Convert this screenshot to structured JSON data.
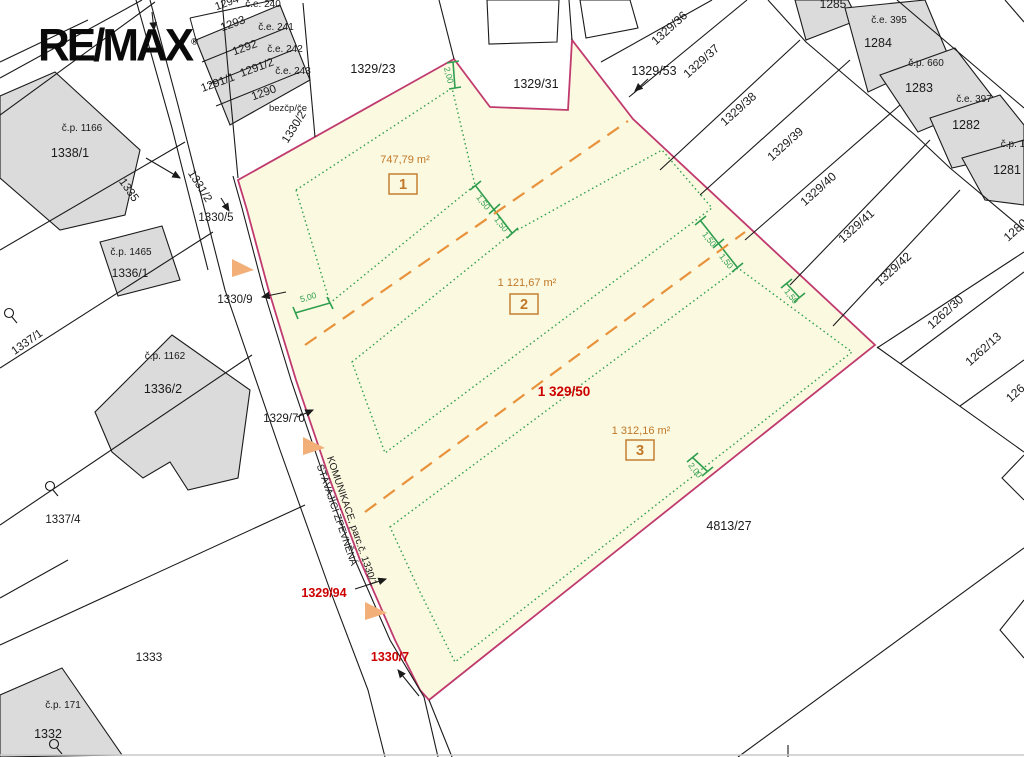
{
  "logo": {
    "text": "RE/MAX",
    "registered": "®"
  },
  "colors": {
    "black": "#1a1a1a",
    "red": "#cc0000",
    "orange": "#c07828",
    "orange_dash": "#e8923c",
    "green": "#2f9e4e",
    "magenta": "#c03a6f",
    "parcel_fill": "#fbf9e0",
    "building_fill": "#dbdbdb",
    "triangle": "#f2b078"
  },
  "parcels": [
    {
      "no": "1",
      "area": "747,79 m²",
      "box_x": 403,
      "box_y": 184,
      "ax": 405,
      "ay": 163
    },
    {
      "no": "2",
      "area": "1 121,67 m²",
      "box_x": 524,
      "box_y": 304,
      "ax": 527,
      "ay": 286
    },
    {
      "no": "3",
      "area": "1 312,16 m²",
      "box_x": 640,
      "box_y": 450,
      "ax": 641,
      "ay": 434
    }
  ],
  "labels": [
    {
      "t": "1294",
      "x": 228,
      "y": 6,
      "r": -20,
      "s": 11,
      "c": "k"
    },
    {
      "t": "č.e. 240",
      "x": 263,
      "y": 7,
      "r": 0,
      "s": 10,
      "c": "k"
    },
    {
      "t": "1293",
      "x": 234,
      "y": 27,
      "r": -20,
      "s": 11.5,
      "c": "k"
    },
    {
      "t": "č.e. 241",
      "x": 276,
      "y": 30,
      "r": 0,
      "s": 10,
      "c": "k"
    },
    {
      "t": "1292",
      "x": 246,
      "y": 51,
      "r": -20,
      "s": 11.5,
      "c": "k"
    },
    {
      "t": "č.e. 242",
      "x": 285,
      "y": 52,
      "r": 0,
      "s": 10,
      "c": "k"
    },
    {
      "t": "1291/2",
      "x": 258,
      "y": 71,
      "r": -20,
      "s": 11.5,
      "c": "k"
    },
    {
      "t": "č.e. 243",
      "x": 293,
      "y": 74,
      "r": 0,
      "s": 10,
      "c": "k"
    },
    {
      "t": "1291/1",
      "x": 219,
      "y": 86,
      "r": -20,
      "s": 11.5,
      "c": "k"
    },
    {
      "t": "1290",
      "x": 265,
      "y": 96,
      "r": -20,
      "s": 11.5,
      "c": "k"
    },
    {
      "t": "bezčp/če",
      "x": 288,
      "y": 111,
      "r": 0,
      "s": 9.5,
      "c": "k"
    },
    {
      "t": "1330/2",
      "x": 297,
      "y": 129,
      "r": -58,
      "s": 11.5,
      "c": "k"
    },
    {
      "t": "č.p. 1166",
      "x": 82,
      "y": 131,
      "r": 0,
      "s": 10,
      "c": "k"
    },
    {
      "t": "1338/1",
      "x": 70,
      "y": 157,
      "r": 0,
      "s": 12.5,
      "c": "k"
    },
    {
      "t": "1335",
      "x": 126,
      "y": 192,
      "r": 55,
      "s": 11.5,
      "c": "k"
    },
    {
      "t": "1331/2",
      "x": 197,
      "y": 188,
      "r": 58,
      "s": 11.5,
      "c": "k"
    },
    {
      "t": "1330/5",
      "x": 216,
      "y": 221,
      "r": 0,
      "s": 11.5,
      "c": "k"
    },
    {
      "t": "1330/9",
      "x": 235,
      "y": 303,
      "r": 0,
      "s": 11.5,
      "c": "k"
    },
    {
      "t": "1337/1",
      "x": 29,
      "y": 345,
      "r": -35,
      "s": 11.5,
      "c": "k"
    },
    {
      "t": "č.p. 1465",
      "x": 131,
      "y": 255,
      "r": 0,
      "s": 10,
      "c": "k"
    },
    {
      "t": "1336/1",
      "x": 130,
      "y": 277,
      "r": 0,
      "s": 12,
      "c": "k"
    },
    {
      "t": "č.p. 1162",
      "x": 165,
      "y": 359,
      "r": 0,
      "s": 10,
      "c": "k"
    },
    {
      "t": "1336/2",
      "x": 163,
      "y": 393,
      "r": 0,
      "s": 12.5,
      "c": "k"
    },
    {
      "t": "1329/70",
      "x": 284,
      "y": 422,
      "r": 0,
      "s": 11.5,
      "c": "k"
    },
    {
      "t": "1337/4",
      "x": 63,
      "y": 523,
      "r": 0,
      "s": 11.5,
      "c": "k"
    },
    {
      "t": "1333",
      "x": 149,
      "y": 661,
      "r": 0,
      "s": 12,
      "c": "k"
    },
    {
      "t": "č.p. 171",
      "x": 63,
      "y": 708,
      "r": 0,
      "s": 10,
      "c": "k"
    },
    {
      "t": "1332",
      "x": 48,
      "y": 738,
      "r": 0,
      "s": 12.5,
      "c": "k"
    },
    {
      "t": "1329/23",
      "x": 373,
      "y": 73,
      "r": 0,
      "s": 12.5,
      "c": "k"
    },
    {
      "t": "1329/31",
      "x": 536,
      "y": 88,
      "r": 0,
      "s": 12.5,
      "c": "k"
    },
    {
      "t": "1329/53",
      "x": 654,
      "y": 75,
      "r": 0,
      "s": 12.5,
      "c": "k"
    },
    {
      "t": "1329/36",
      "x": 672,
      "y": 31,
      "r": -42,
      "s": 12,
      "c": "k"
    },
    {
      "t": "1329/37",
      "x": 704,
      "y": 64,
      "r": -42,
      "s": 12,
      "c": "k"
    },
    {
      "t": "1329/38",
      "x": 741,
      "y": 112,
      "r": -42,
      "s": 12,
      "c": "k"
    },
    {
      "t": "1329/39",
      "x": 788,
      "y": 147,
      "r": -42,
      "s": 12,
      "c": "k"
    },
    {
      "t": "1329/40",
      "x": 821,
      "y": 192,
      "r": -42,
      "s": 12,
      "c": "k"
    },
    {
      "t": "1329/41",
      "x": 859,
      "y": 229,
      "r": -42,
      "s": 12,
      "c": "k"
    },
    {
      "t": "1329/42",
      "x": 896,
      "y": 272,
      "r": -42,
      "s": 12,
      "c": "k"
    },
    {
      "t": "1262/30",
      "x": 948,
      "y": 315,
      "r": -42,
      "s": 12,
      "c": "k"
    },
    {
      "t": "1262/13",
      "x": 986,
      "y": 352,
      "r": -42,
      "s": 12,
      "c": "k"
    },
    {
      "t": "1280",
      "x": 1018,
      "y": 233,
      "r": -42,
      "s": 12,
      "c": "k"
    },
    {
      "t": "126",
      "x": 1018,
      "y": 396,
      "r": -42,
      "s": 12,
      "c": "k"
    },
    {
      "t": "1285",
      "x": 833,
      "y": 8,
      "r": 0,
      "s": 12,
      "c": "k"
    },
    {
      "t": "č.e. 395",
      "x": 889,
      "y": 23,
      "r": 0,
      "s": 10,
      "c": "k"
    },
    {
      "t": "1284",
      "x": 878,
      "y": 47,
      "r": 0,
      "s": 12.5,
      "c": "k"
    },
    {
      "t": "č.p. 660",
      "x": 926,
      "y": 66,
      "r": 0,
      "s": 10,
      "c": "k"
    },
    {
      "t": "1283",
      "x": 919,
      "y": 92,
      "r": 0,
      "s": 12.5,
      "c": "k"
    },
    {
      "t": "č.e. 397",
      "x": 974,
      "y": 102,
      "r": 0,
      "s": 10,
      "c": "k"
    },
    {
      "t": "1282",
      "x": 966,
      "y": 129,
      "r": 0,
      "s": 12.5,
      "c": "k"
    },
    {
      "t": "č.p. 1",
      "x": 1013,
      "y": 147,
      "r": 0,
      "s": 10,
      "c": "k"
    },
    {
      "t": "1281",
      "x": 1007,
      "y": 174,
      "r": 0,
      "s": 12.5,
      "c": "k"
    },
    {
      "t": "4813/27",
      "x": 729,
      "y": 530,
      "r": 0,
      "s": 12.5,
      "c": "k"
    },
    {
      "t": "1 329/50",
      "x": 564,
      "y": 396,
      "r": 0,
      "s": 13.5,
      "c": "r",
      "b": 1,
      "n": "parcel-1329-50-label"
    },
    {
      "t": "1329/94",
      "x": 324,
      "y": 597,
      "r": 0,
      "s": 12.5,
      "c": "r",
      "b": 1,
      "n": "parcel-1329-94-label"
    },
    {
      "t": "1330/7",
      "x": 390,
      "y": 661,
      "r": 0,
      "s": 12.5,
      "c": "r",
      "b": 1,
      "n": "parcel-1330-7-label"
    },
    {
      "t": "STÁVAJÍCÍ ZPEVNĚNÁ",
      "x": 334,
      "y": 516,
      "r": 71,
      "s": 10,
      "c": "k",
      "n": "road-name-line1"
    },
    {
      "t": "KOMUNIKACE, parc.č. 1330/1",
      "x": 349,
      "y": 522,
      "r": 71,
      "s": 10,
      "c": "k",
      "n": "road-name-line2"
    },
    {
      "t": "2,00",
      "x": 446,
      "y": 76,
      "r": 75,
      "s": 8.5,
      "c": "g"
    },
    {
      "t": "5,00",
      "x": 309,
      "y": 300,
      "r": -16,
      "s": 8.5,
      "c": "g"
    },
    {
      "t": "1,50",
      "x": 481,
      "y": 204,
      "r": 52,
      "s": 8.5,
      "c": "g"
    },
    {
      "t": "1,50",
      "x": 499,
      "y": 226,
      "r": 52,
      "s": 8.5,
      "c": "g"
    },
    {
      "t": "1,50",
      "x": 707,
      "y": 241,
      "r": 52,
      "s": 8.5,
      "c": "g"
    },
    {
      "t": "1,50",
      "x": 724,
      "y": 263,
      "r": 52,
      "s": 8.5,
      "c": "g"
    },
    {
      "t": "1,50",
      "x": 789,
      "y": 298,
      "r": 52,
      "s": 8.5,
      "c": "g"
    },
    {
      "t": "2,00",
      "x": 693,
      "y": 472,
      "r": 52,
      "s": 8.5,
      "c": "g"
    }
  ]
}
